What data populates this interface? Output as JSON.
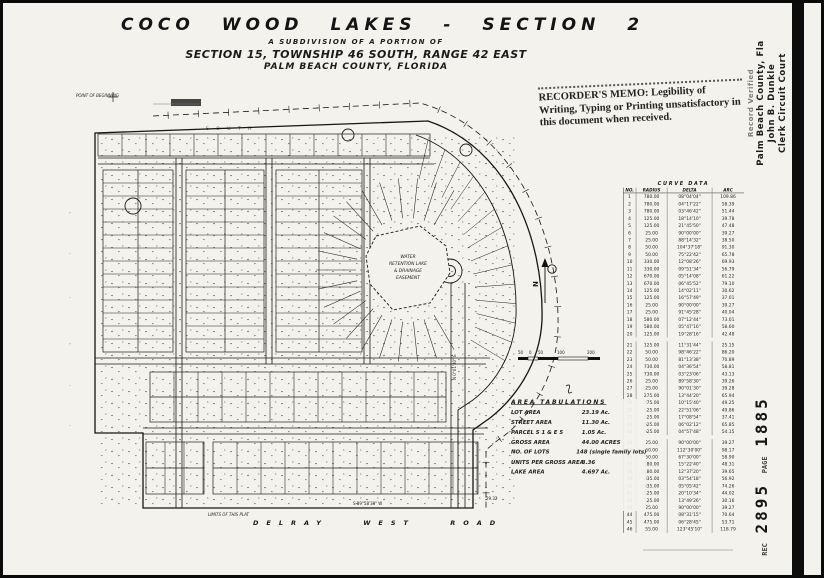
{
  "title_block": {
    "line1": "COCO WOOD LAKES - SECTION 2",
    "line2": "A SUBDIVISION OF A PORTION OF",
    "line3": "SECTION 15, TOWNSHIP 46 SOUTH, RANGE 42 EAST",
    "line4": "PALM BEACH COUNTY, FLORIDA"
  },
  "recorders_memo": {
    "lead": "RECORDER'S MEMO:",
    "rest": " Legibility of Writing, Typing or Printing unsatisfactory in this document when received."
  },
  "margin_stamp": {
    "line1": "Record Verified",
    "line2": "Palm Beach County, Fla",
    "line3": "John B. Dunkle",
    "line4": "Clerk Circuit Court"
  },
  "book_stamp": {
    "rec_label": "REC",
    "book": "2895",
    "page_label": "PAGE",
    "page": "1885"
  },
  "curve_table": {
    "title": "CURVE DATA",
    "headers": [
      "NO.",
      "RADIUS",
      "DELTA",
      "ARC"
    ],
    "rows": [
      [
        "1",
        "780.00",
        "08°04'04\"",
        "109.86"
      ],
      [
        "2",
        "780.00",
        "04°17'22\"",
        "58.39"
      ],
      [
        "3",
        "780.00",
        "03°46'42\"",
        "51.44"
      ],
      [
        "4",
        "125.00",
        "18°14'10\"",
        "39.78"
      ],
      [
        "5",
        "125.00",
        "21°45'50\"",
        "47.48"
      ],
      [
        "6",
        "25.00",
        "90°00'00\"",
        "39.27"
      ],
      [
        "7",
        "25.00",
        "88°14'32\"",
        "38.50"
      ],
      [
        "8",
        "50.00",
        "104°37'18\"",
        "91.30"
      ],
      [
        "9",
        "50.00",
        "75°22'42\"",
        "65.78"
      ],
      [
        "10",
        "330.00",
        "12°08'26\"",
        "69.93"
      ],
      [
        "11",
        "330.00",
        "09°51'34\"",
        "56.79"
      ],
      [
        "12",
        "670.00",
        "05°14'08\"",
        "61.22"
      ],
      [
        "13",
        "670.00",
        "06°45'52\"",
        "79.10"
      ],
      [
        "14",
        "125.00",
        "14°02'11\"",
        "30.62"
      ],
      [
        "15",
        "125.00",
        "16°57'49\"",
        "37.01"
      ],
      [
        "16",
        "25.00",
        "90°00'00\"",
        "39.27"
      ],
      [
        "17",
        "25.00",
        "91°45'28\"",
        "40.04"
      ],
      [
        "18",
        "580.00",
        "07°12'44\"",
        "73.01"
      ],
      [
        "19",
        "580.00",
        "05°47'16\"",
        "58.60"
      ],
      [
        "20",
        "125.00",
        "19°28'16\"",
        "42.48"
      ],
      [
        "21",
        "125.00",
        "11°31'44\"",
        "25.15"
      ],
      [
        "22",
        "50.00",
        "98°46'22\"",
        "86.20"
      ],
      [
        "23",
        "50.00",
        "81°13'38\"",
        "70.89"
      ],
      [
        "24",
        "730.00",
        "04°36'54\"",
        "58.81"
      ],
      [
        "25",
        "730.00",
        "03°23'06\"",
        "43.13"
      ],
      [
        "26",
        "25.00",
        "89°58'30\"",
        "39.26"
      ],
      [
        "27",
        "25.00",
        "90°01'30\"",
        "39.28"
      ],
      [
        "28",
        "275.00",
        "13°44'20\"",
        "65.94"
      ],
      [
        "29",
        "275.00",
        "10°15'40\"",
        "49.25"
      ],
      [
        "30",
        "125.00",
        "22°51'06\"",
        "49.86"
      ],
      [
        "31",
        "125.00",
        "17°08'54\"",
        "37.41"
      ],
      [
        "32",
        "625.00",
        "06°02'12\"",
        "65.85"
      ],
      [
        "33",
        "625.00",
        "04°57'48\"",
        "54.15"
      ],
      [
        "34",
        "25.00",
        "90°00'00\"",
        "39.27"
      ],
      [
        "35",
        "50.00",
        "112°30'00\"",
        "98.17"
      ],
      [
        "36",
        "50.00",
        "67°30'00\"",
        "58.90"
      ],
      [
        "37",
        "180.00",
        "15°22'40\"",
        "48.31"
      ],
      [
        "38",
        "180.00",
        "12°37'20\"",
        "39.65"
      ],
      [
        "39",
        "835.00",
        "03°54'18\"",
        "56.92"
      ],
      [
        "40",
        "835.00",
        "05°05'42\"",
        "74.26"
      ],
      [
        "41",
        "125.00",
        "20°10'34\"",
        "44.02"
      ],
      [
        "42",
        "125.00",
        "13°49'26\"",
        "30.16"
      ],
      [
        "43",
        "25.00",
        "90°00'00\"",
        "39.27"
      ],
      [
        "44",
        "475.00",
        "08°31'15\"",
        "70.64"
      ],
      [
        "45",
        "475.00",
        "06°28'45\"",
        "53.71"
      ],
      [
        "46",
        "55.00",
        "123°45'10\"",
        "118.79"
      ]
    ]
  },
  "area_tabulations": {
    "title": "AREA TABULATIONS",
    "rows": [
      {
        "label": "LOT AREA",
        "value": "23.19 Ac."
      },
      {
        "label": "STREET AREA",
        "value": "11.30 Ac."
      },
      {
        "label": "PARCEL S 1 & E 5",
        "value": "1.05 Ac."
      },
      {
        "label": "GROSS AREA",
        "value": "44.00 ACRES"
      },
      {
        "label": "NO. OF LOTS",
        "value": "148 (single family lots)"
      },
      {
        "label": "UNITS PER GROSS AREA",
        "value": "3.36"
      },
      {
        "label": "LAKE AREA",
        "value": "4.697 Ac."
      }
    ]
  },
  "map": {
    "road_label": "DELRAY WEST ROAD",
    "limits_label": "LIMITS OF THIS PLAT",
    "south_label": "S O U T H",
    "pob_label": "POINT OF BEGINNING",
    "lake_label_lines": [
      "WATER",
      "RETENTION LAKE",
      "& DRAINAGE",
      "EASEMENT"
    ],
    "north_label": "N",
    "scale_labels": [
      "50",
      "0",
      "50",
      "100",
      "200"
    ],
    "bearing_right": "N 0°01'30\" E",
    "bearing_bottom": "S 89°58'30\" W",
    "corner_dim": "29.32"
  }
}
